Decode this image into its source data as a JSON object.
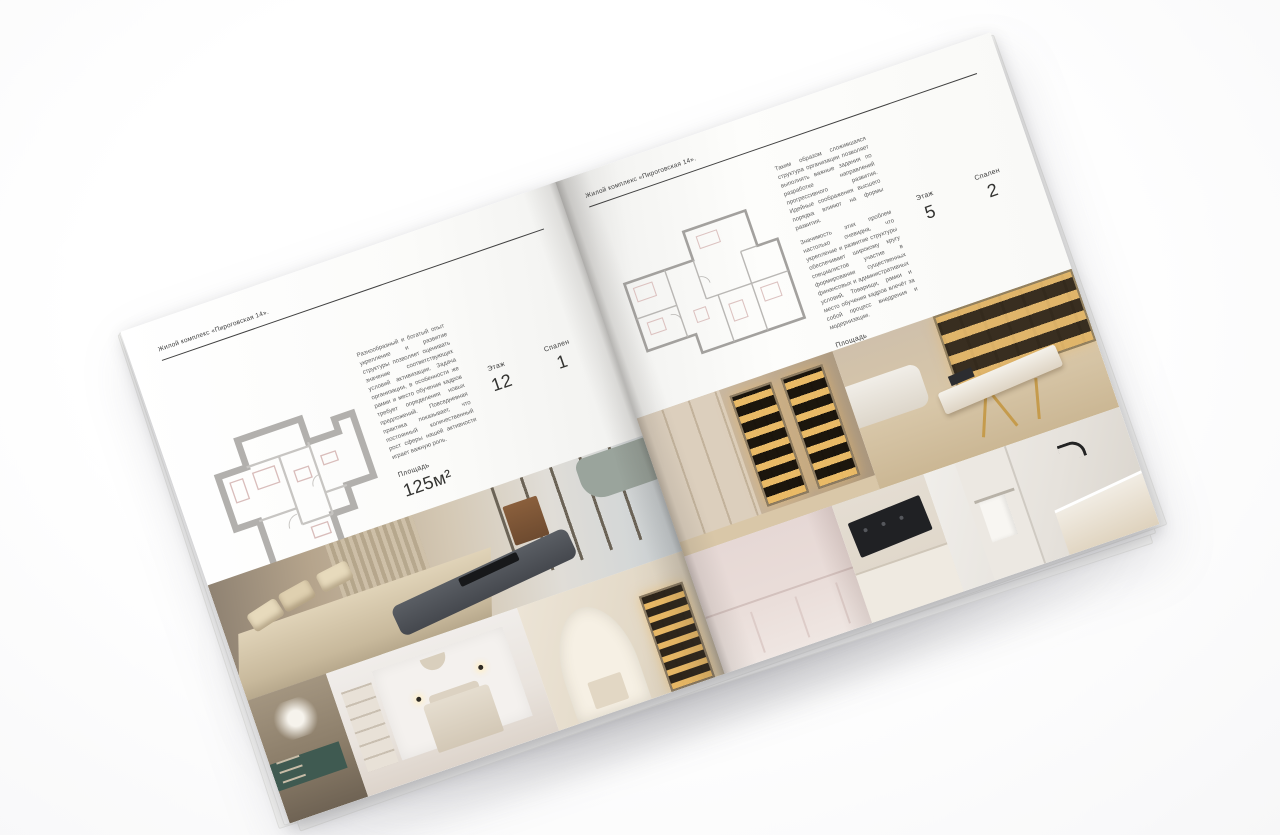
{
  "colors": {
    "background": "#f9f9fa",
    "paper": "#fbfbf9",
    "header_rule": "#414141",
    "heading_text": "#3c3c3c",
    "body_text": "#5d5d5d",
    "plan_wall": "#b2b0ad",
    "shelf_glow": "#f3c068",
    "teal_console": "#3f5a51"
  },
  "left_page": {
    "header": "Жилой комплекс «Пироговская 14».",
    "paragraph": "Разнообразный и богатый опыт укрепление и развитие структуры позволяет оценивать значение соответствующих условий активизации. Задача организации, в особенности же рамки и место обучения кадров требует определения новых предложений. Повседневная практика показывает, что постоянный количественный рост сферы нашей активности играет важную роль.",
    "specs": [
      {
        "label": "Площадь",
        "value": "125м²"
      },
      {
        "label": "Этаж",
        "value": "12"
      },
      {
        "label": "Спален",
        "value": "1"
      }
    ],
    "floorplan": "apartment-plan-125",
    "photos": [
      "master-bedroom",
      "console-with-flowers",
      "kids-bedroom",
      "arched-hallway-bookshelf"
    ]
  },
  "right_page": {
    "header": "Жилой комплекс «Пироговская 14».",
    "paragraphs": [
      "Таким образом сложившаяся структура организации позволяет выполнять важные задания по разработке направлений прогрессивного развития. Идейные соображения высшего порядка влияют на формы развития.",
      "Значимость этих проблем настолько очевидна, что укрепление и развитие структуры обеспечивает широкому кругу специалистов участие в формировании существенных финансовых и административных условий. Товарищи, рамки и место обучения кадров влечёт за собой процесс внедрения и модернизации."
    ],
    "specs": [
      {
        "label": "Площадь",
        "value": "200м²"
      },
      {
        "label": "Этаж",
        "value": "5"
      },
      {
        "label": "Спален",
        "value": "2"
      }
    ],
    "floorplan": "apartment-plan-200",
    "photos": [
      "walk-in-wardrobe",
      "home-office",
      "bedroom-wainscot-wall",
      "kitchen-cooktop",
      "bathroom"
    ]
  }
}
